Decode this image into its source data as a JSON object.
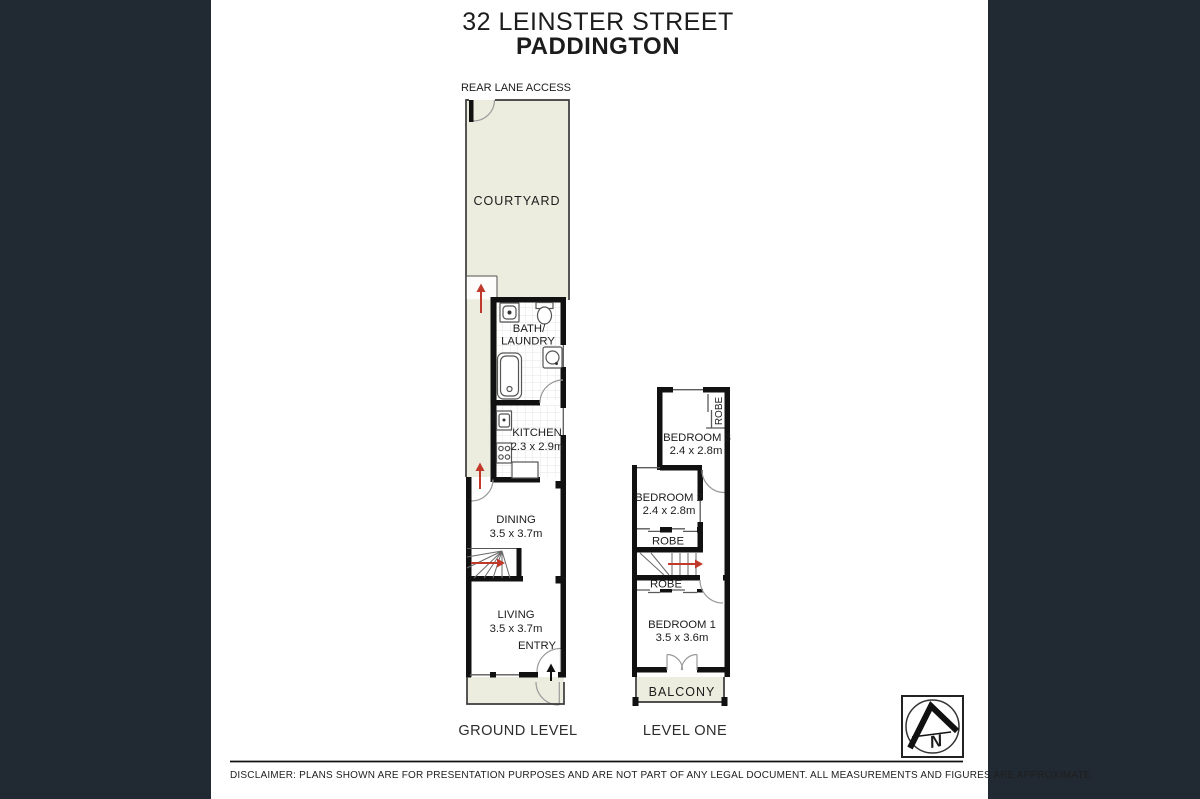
{
  "header": {
    "line1": "32 LEINSTER STREET",
    "line2": "PADDINGTON"
  },
  "ground": {
    "rear_lane": "REAR LANE ACCESS",
    "courtyard": "COURTYARD",
    "bath1": "BATH/",
    "bath2": "LAUNDRY",
    "kitchen": "KITCHEN",
    "kitchen_dims": "2.3 x 2.9m",
    "dining": "DINING",
    "dining_dims": "3.5 x 3.7m",
    "living": "LIVING",
    "living_dims": "3.5 x 3.7m",
    "entry": "ENTRY",
    "caption": "GROUND LEVEL"
  },
  "level_one": {
    "bed3": "BEDROOM 3",
    "bed3_dims": "2.4 x 2.8m",
    "robe_bed3": "ROBE",
    "bed2": "BEDROOM 2",
    "bed2_dims": "2.4 x 2.8m",
    "robe_bed2": "ROBE",
    "robe_bed1": "ROBE",
    "bed1": "BEDROOM 1",
    "bed1_dims": "3.5 x 3.6m",
    "balcony": "BALCONY",
    "caption": "LEVEL ONE"
  },
  "compass": {
    "letter": "N"
  },
  "footer": {
    "disclaimer": "DISCLAIMER:  PLANS SHOWN ARE FOR PRESENTATION PURPOSES AND ARE NOT PART OF ANY LEGAL DOCUMENT. ALL MEASUREMENTS AND FIGURES ARE APPROXIMATE."
  },
  "colors": {
    "side_bars": "#212a33",
    "outdoor_fill": "#ecedde",
    "wall": "#111111",
    "arrow_red": "#c0392b"
  }
}
